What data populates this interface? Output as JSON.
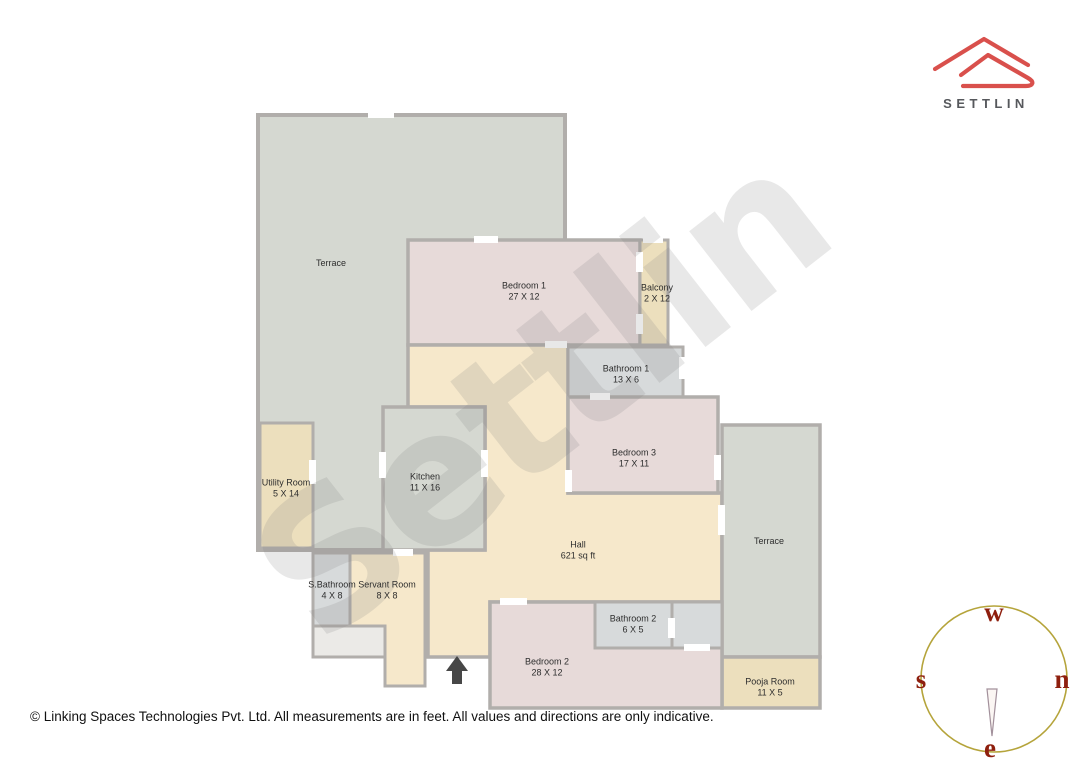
{
  "logo": {
    "brand": "SETTLIN"
  },
  "watermark": {
    "text": "Settlin"
  },
  "rooms": [
    {
      "name": "Terrace",
      "dims": ""
    },
    {
      "name": "Bedroom 1",
      "dims": "27 X 12"
    },
    {
      "name": "Balcony",
      "dims": "2 X 12"
    },
    {
      "name": "Bathroom 1",
      "dims": "13 X 6"
    },
    {
      "name": "Bedroom 3",
      "dims": "17 X 11"
    },
    {
      "name": "Utility Room",
      "dims": "5 X 14"
    },
    {
      "name": "Kitchen",
      "dims": "11 X 16"
    },
    {
      "name": "Hall",
      "dims": "621 sq ft"
    },
    {
      "name": "Terrace",
      "dims": ""
    },
    {
      "name": "S.Bathroom",
      "dims": "4 X 8"
    },
    {
      "name": "Servant Room",
      "dims": "8 X 8"
    },
    {
      "name": "Bathroom 2",
      "dims": "6 X 5"
    },
    {
      "name": "Bedroom 2",
      "dims": "28 X 12"
    },
    {
      "name": "Pooja Room",
      "dims": "11 X 5"
    }
  ],
  "compass": {
    "west": "w",
    "north": "n",
    "south": "s",
    "east": "e"
  },
  "footer": {
    "text": "© Linking Spaces Technologies Pvt. Ltd. All measurements are in feet. All values and directions are only indicative."
  },
  "palette": {
    "terrace_fill": "#d5d8d1",
    "bedroom_fill": "#e7dad9",
    "hall_fill": "#f6e8cb",
    "utility_fill": "#ecdfbd",
    "bathroom_fill": "#d7dadb",
    "wall": "#b1aeab",
    "brand_red": "#d9504c",
    "compass_letter": "#8e1f0e",
    "compass_circle": "#b5a43b"
  }
}
